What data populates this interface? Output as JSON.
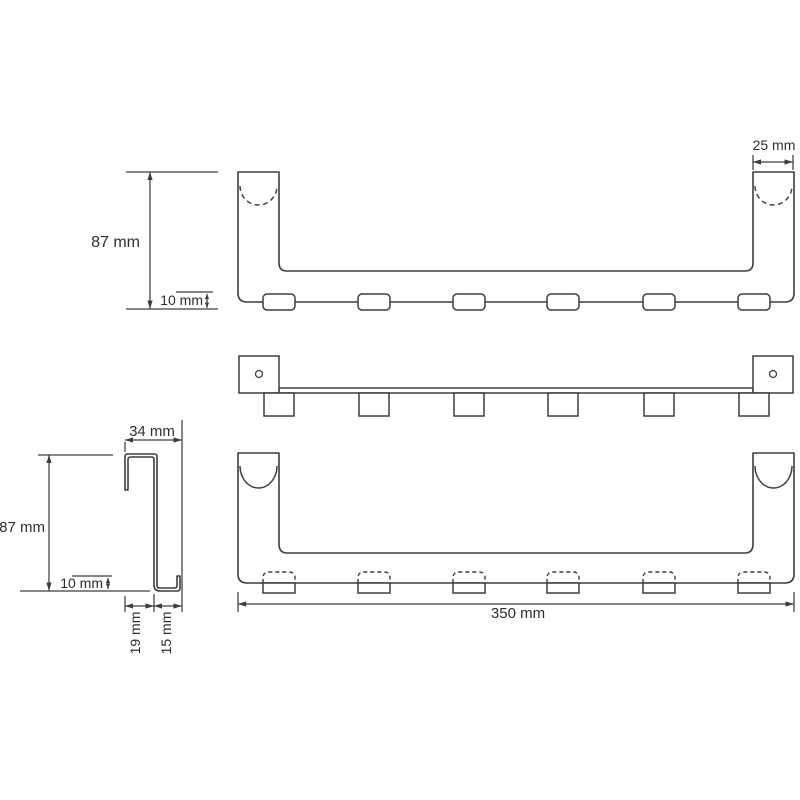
{
  "drawing": {
    "kind": "dimensioned technical drawing, over-door hook rail, 3 orthographic views + side profile",
    "units": "mm",
    "hook_count": 6,
    "mounting_hole_count": 2,
    "front": {
      "height": "87 mm",
      "hook_depth": "10 mm",
      "end_width": "25 mm"
    },
    "rear": {
      "overall_width": "350 mm"
    },
    "side": {
      "depth": "34 mm",
      "height": "87 mm",
      "lip_height": "10 mm",
      "channel_width": "19 mm",
      "lip_offset": "15 mm"
    },
    "colors": {
      "line": "#3d3d3d",
      "background": "#ffffff"
    }
  }
}
